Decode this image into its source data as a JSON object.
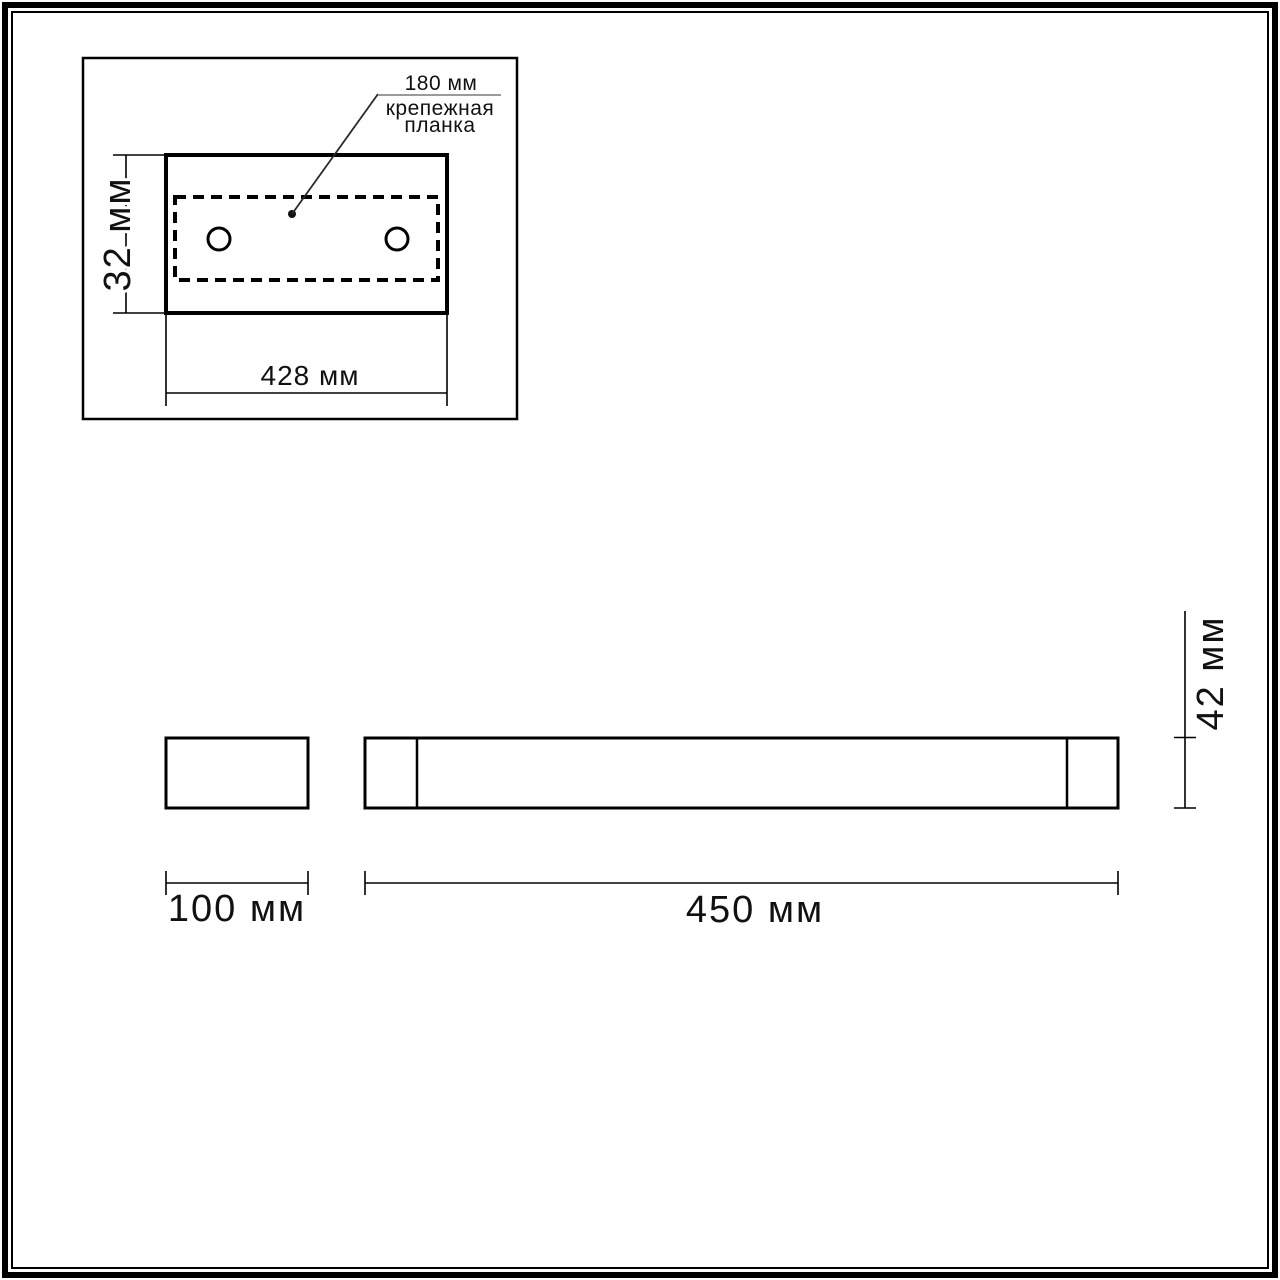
{
  "colors": {
    "line": "#000000",
    "leader_diagonal": "#2a2a2a",
    "leader_underline": "#9a9a9a",
    "background": "#ffffff"
  },
  "inset_view": {
    "leader": {
      "value": "180 мм",
      "label_line1": "крепежная",
      "label_line2": "планка"
    },
    "height_dim": "32 мм",
    "width_dim": "428 мм"
  },
  "side_view": {
    "width_dim": "100 мм"
  },
  "front_view": {
    "height_dim": "42 мм",
    "length_dim": "450 мм"
  }
}
